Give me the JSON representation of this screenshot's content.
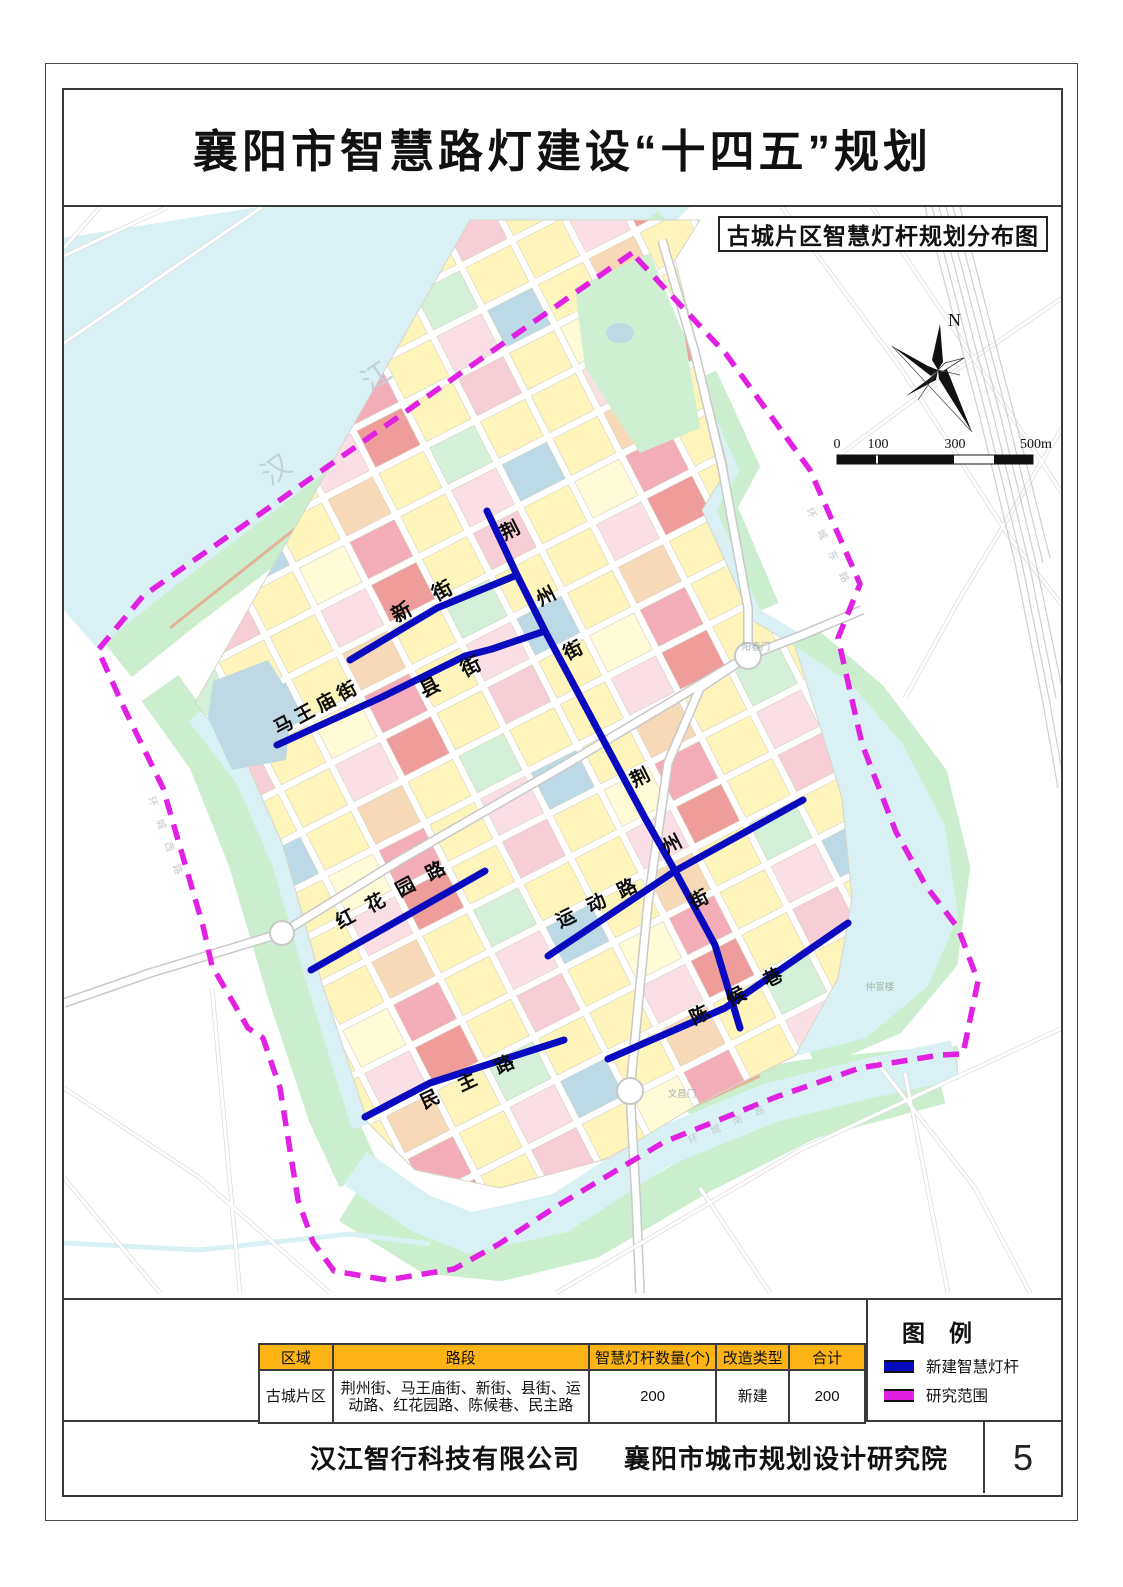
{
  "page": {
    "title": "襄阳市智慧路灯建设“十四五”规划",
    "page_number": "5",
    "footer_company_left": "汉江智行科技有限公司",
    "footer_company_right": "襄阳市城市规划设计研究院"
  },
  "map": {
    "subtitle": "古城片区智慧灯杆规划分布图",
    "north_label": "N",
    "scale": {
      "t0": "0",
      "t1": "100",
      "t3": "300",
      "t5": "500m"
    },
    "river": {
      "c0": "汉",
      "c1": "江"
    },
    "streets": {
      "jingzhou_top": {
        "c0": "荆",
        "c1": "州",
        "c2": "街"
      },
      "jingzhou_mid": {
        "c0": "荆",
        "c1": "州",
        "c2": "街"
      },
      "xinjie": "新街",
      "xianjie": "县街",
      "mawangmiao": "马王庙街",
      "honghuayuan": "红花园路",
      "yundonglu": "运动路",
      "chenhouxiang": "陈候巷",
      "minzhulu": "民主路"
    },
    "gates": {
      "yangchunmen": "阳春门",
      "wenchangmen": "文昌门"
    },
    "poi": {
      "zhongxuanlou": "仲宣楼"
    },
    "ring_roads": {
      "east": "环城东路",
      "south": "环城南路",
      "west": "环城西路"
    }
  },
  "legend": {
    "title": "图例",
    "items": [
      {
        "label": "新建智慧灯杆",
        "color": "#0A0ABE",
        "style": "solid-line"
      },
      {
        "label": "研究范围",
        "color": "#E121E1",
        "style": "dashed-boundary"
      }
    ]
  },
  "table": {
    "headers": [
      "区域",
      "路段",
      "智慧灯杆数量(个)",
      "改造类型",
      "合计"
    ],
    "row": {
      "area": "古城片区",
      "roads": "荆州街、马王庙街、新街、县街、运动路、红花园路、陈候巷、民主路",
      "count": "200",
      "type": "新建",
      "total": "200"
    }
  },
  "colors": {
    "new_pole_line": "#0A0ABE",
    "study_boundary": "#E121E1",
    "table_header_bg": "#FDB414",
    "river_water": "#D9F1F4",
    "greenbelt": "#CBEECF"
  }
}
